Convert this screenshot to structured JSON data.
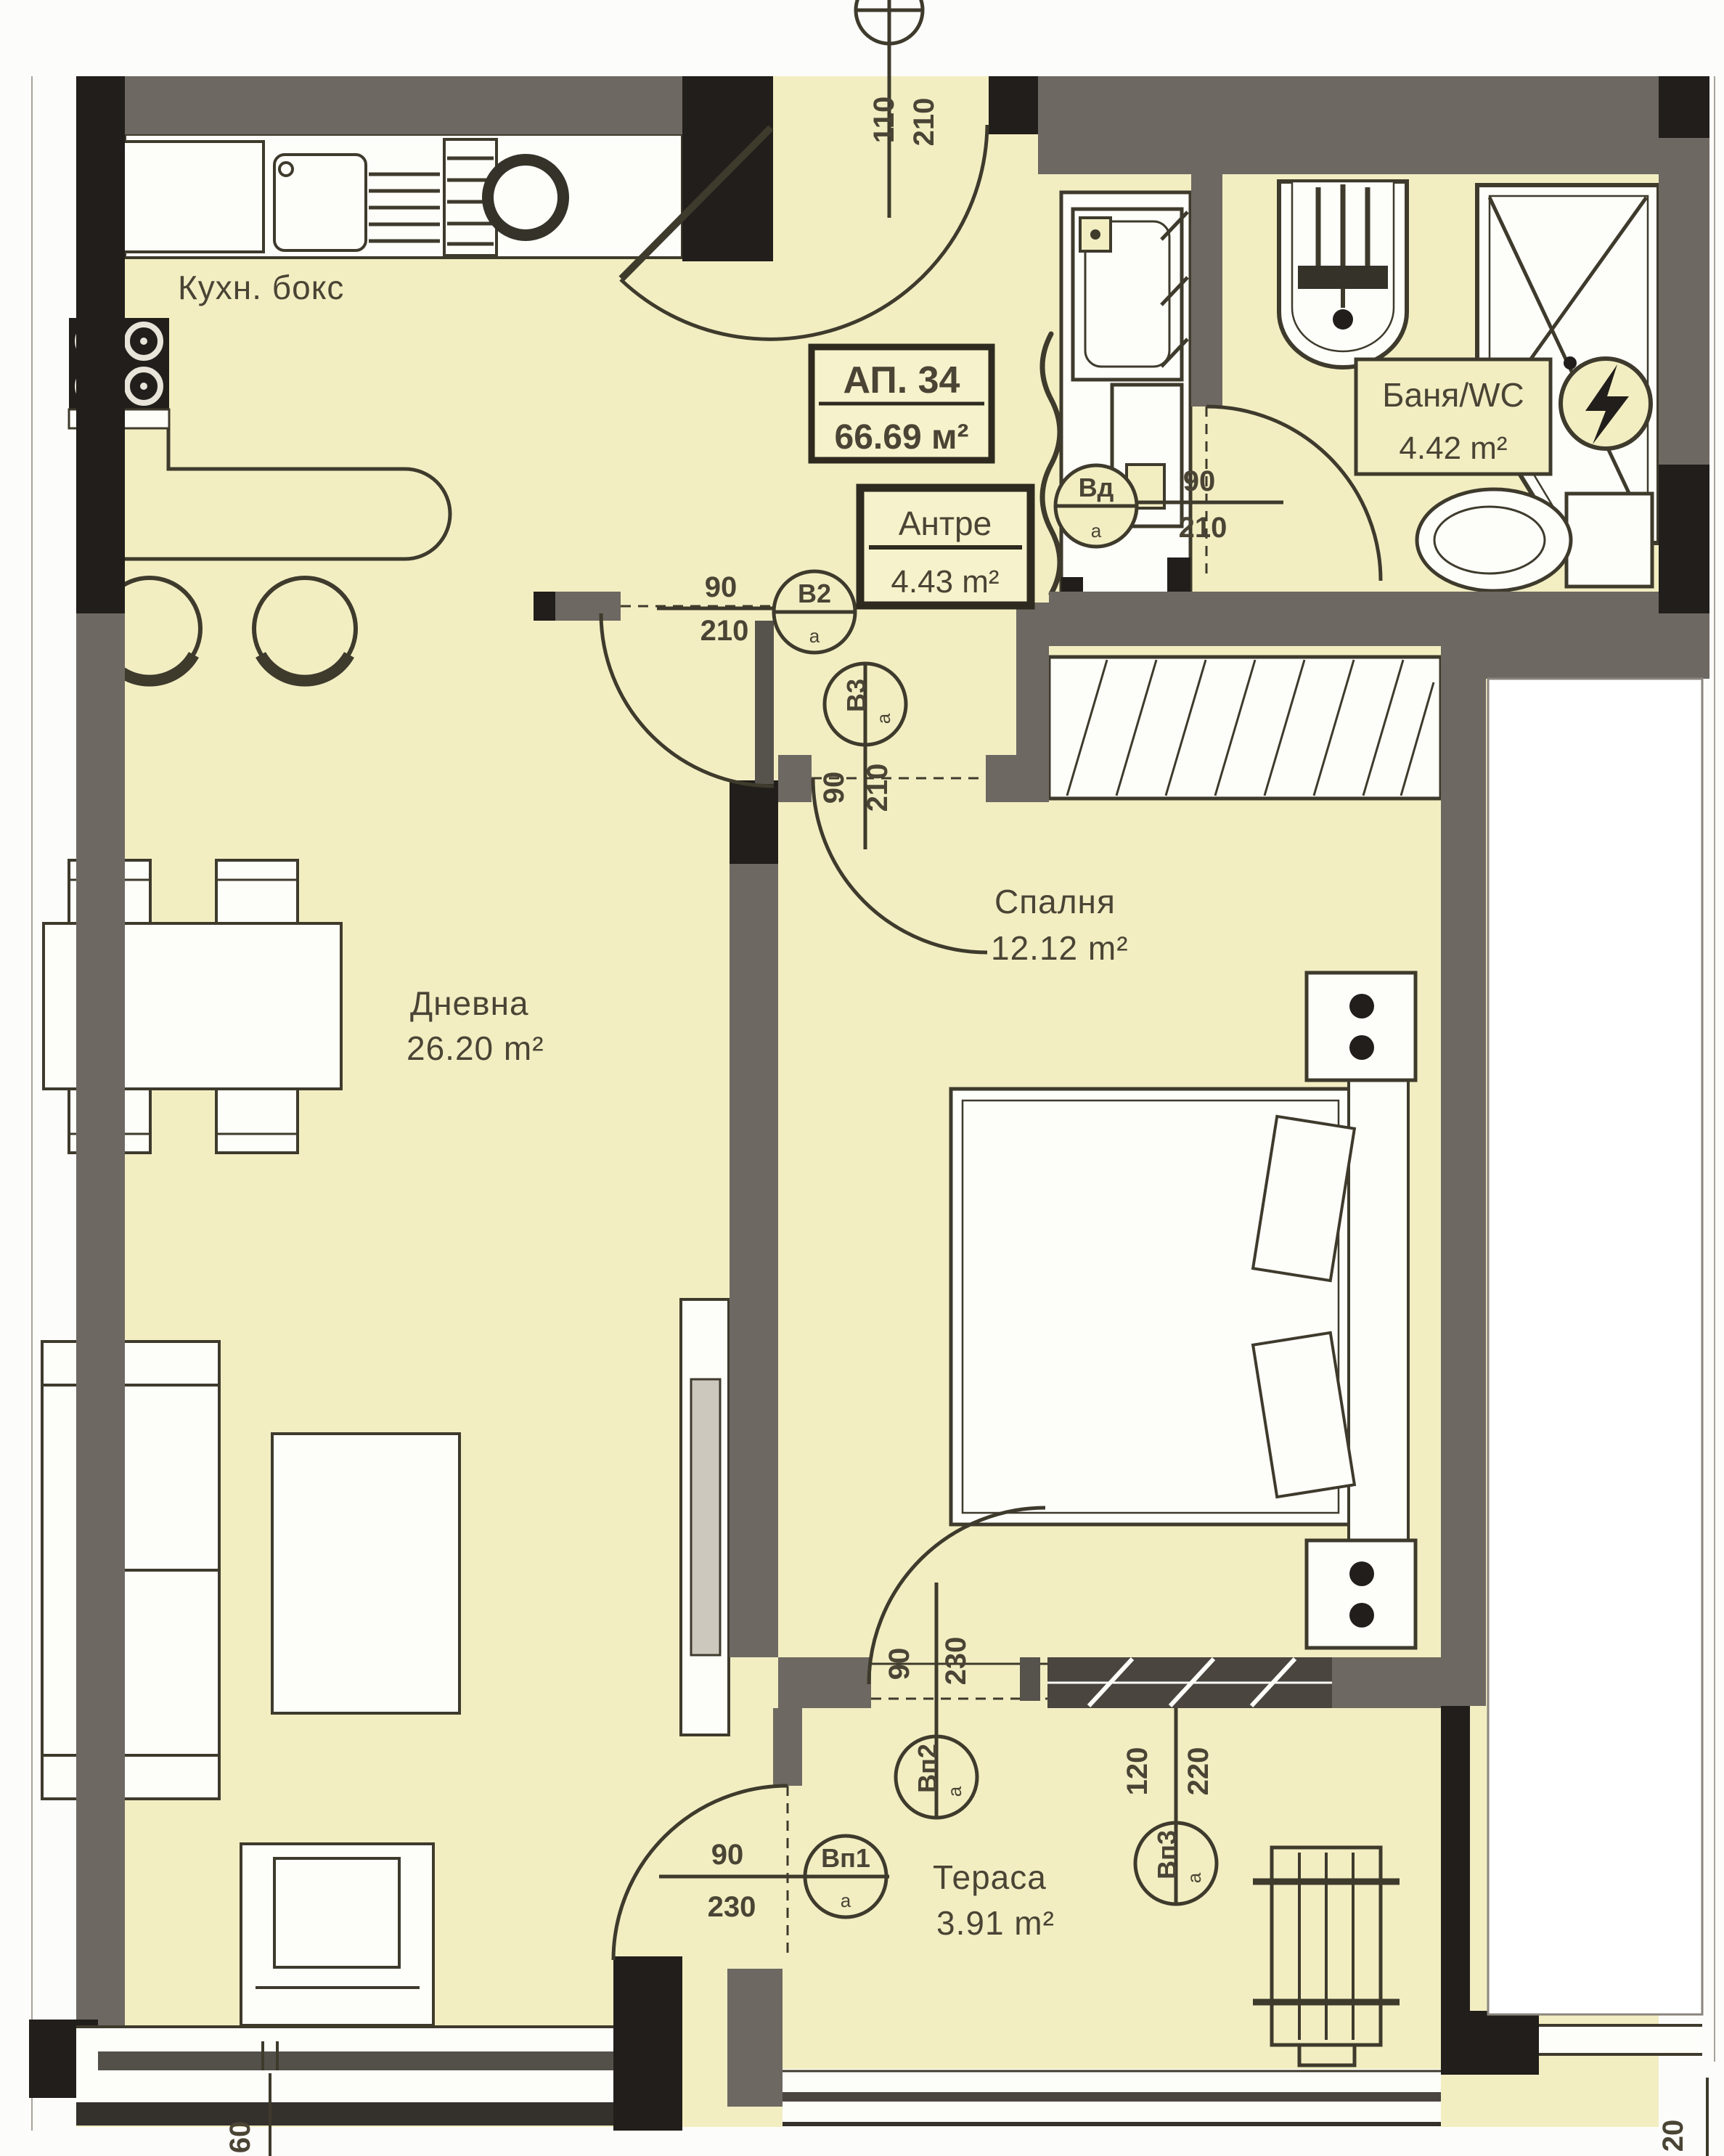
{
  "plan": {
    "unit_title": "АП. 34",
    "unit_area": "66.69 м²",
    "kitchen_label": "Кухн. бокс",
    "rooms": {
      "hall": {
        "name": "Антре",
        "area": "4.43 m²"
      },
      "bathroom": {
        "name": "Баня/WC",
        "area": "4.42 m²"
      },
      "living": {
        "name": "Дневна",
        "area": "26.20 m²"
      },
      "bedroom": {
        "name": "Спалня",
        "area": "12.12 m²"
      },
      "terrace": {
        "name": "Тераса",
        "area": "3.91 m²"
      }
    },
    "openings": {
      "entry": {
        "width": "110",
        "height": "210"
      },
      "living_door": {
        "width": "90",
        "height": "210",
        "tag": "В2",
        "tag_sub": "а"
      },
      "bedroom_door": {
        "width": "90",
        "height": "210",
        "tag": "В3",
        "tag_sub": "а"
      },
      "bath_door": {
        "width": "90",
        "height": "210",
        "tag": "Вд",
        "tag_sub": "а"
      },
      "living_terrace_door": {
        "width": "90",
        "height": "230",
        "tag": "Вп1",
        "tag_sub": "а"
      },
      "bedroom_terrace_door": {
        "width": "90",
        "height": "230",
        "tag": "Вп2",
        "tag_sub": "а"
      },
      "terrace_window": {
        "width": "120",
        "height": "220",
        "tag": "Вп3",
        "tag_sub": "а"
      },
      "edge_left_cut": "60",
      "edge_right_cut": "20"
    },
    "colors": {
      "room_fill": "#f2eec2",
      "wall_gray": "#6e6862",
      "wall_black": "#211e1b",
      "line": "#3e3a2c",
      "text": "#4a4435",
      "paper": "#fcfcfa",
      "fixture": "#fdfdf9"
    }
  }
}
